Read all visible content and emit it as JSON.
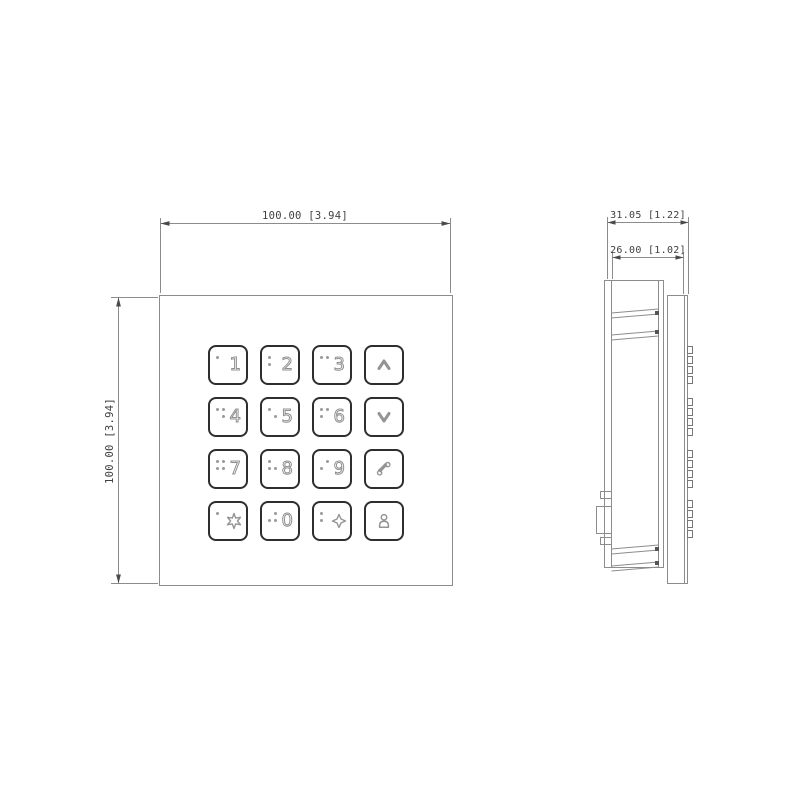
{
  "drawing": {
    "front_view": {
      "width_dim": "100.00 [3.94]",
      "height_dim": "100.00 [3.94]"
    },
    "side_view": {
      "depth_total_dim": "31.05 [1.22]",
      "depth_box_dim": "26.00 [1.02]"
    },
    "keypad": {
      "buttons": [
        {
          "key": "1",
          "type": "digit",
          "label": "1",
          "braille": [
            [
              0,
              0
            ]
          ]
        },
        {
          "key": "2",
          "type": "digit",
          "label": "2",
          "braille": [
            [
              0,
              0
            ],
            [
              0,
              1
            ]
          ]
        },
        {
          "key": "3",
          "type": "digit",
          "label": "3",
          "braille": [
            [
              0,
              0
            ],
            [
              1,
              0
            ]
          ]
        },
        {
          "key": "up",
          "type": "icon",
          "icon": "chevron-up-icon"
        },
        {
          "key": "4",
          "type": "digit",
          "label": "4",
          "braille": [
            [
              0,
              0
            ],
            [
              1,
              0
            ],
            [
              1,
              1
            ]
          ]
        },
        {
          "key": "5",
          "type": "digit",
          "label": "5",
          "braille": [
            [
              0,
              0
            ],
            [
              1,
              1
            ]
          ]
        },
        {
          "key": "6",
          "type": "digit",
          "label": "6",
          "braille": [
            [
              0,
              0
            ],
            [
              0,
              1
            ],
            [
              1,
              0
            ]
          ]
        },
        {
          "key": "down",
          "type": "icon",
          "icon": "chevron-down-icon"
        },
        {
          "key": "7",
          "type": "digit",
          "label": "7",
          "braille": [
            [
              0,
              0
            ],
            [
              0,
              1
            ],
            [
              1,
              0
            ],
            [
              1,
              1
            ]
          ]
        },
        {
          "key": "8",
          "type": "digit",
          "label": "8",
          "braille": [
            [
              0,
              0
            ],
            [
              0,
              1
            ],
            [
              1,
              1
            ]
          ]
        },
        {
          "key": "9",
          "type": "digit",
          "label": "9",
          "braille": [
            [
              0,
              1
            ],
            [
              1,
              0
            ]
          ]
        },
        {
          "key": "call",
          "type": "icon",
          "icon": "phone-icon"
        },
        {
          "key": "*",
          "type": "icon-star",
          "icon": "star6-icon",
          "braille": [
            [
              0,
              0
            ]
          ]
        },
        {
          "key": "0",
          "type": "digit",
          "label": "0",
          "braille": [
            [
              0,
              1
            ],
            [
              1,
              0
            ],
            [
              1,
              1
            ]
          ]
        },
        {
          "key": "#",
          "type": "icon-star",
          "icon": "star4-icon",
          "braille": [
            [
              0,
              0
            ],
            [
              0,
              1
            ]
          ]
        },
        {
          "key": "person",
          "type": "icon",
          "icon": "person-icon"
        }
      ]
    },
    "colors": {
      "background": "#ffffff",
      "drawing_line": "#8c8c8c",
      "button_outline": "#2e2e2e",
      "engraved_glyph": "#9a9a9a",
      "dimension_text": "#3f3f3f"
    }
  }
}
